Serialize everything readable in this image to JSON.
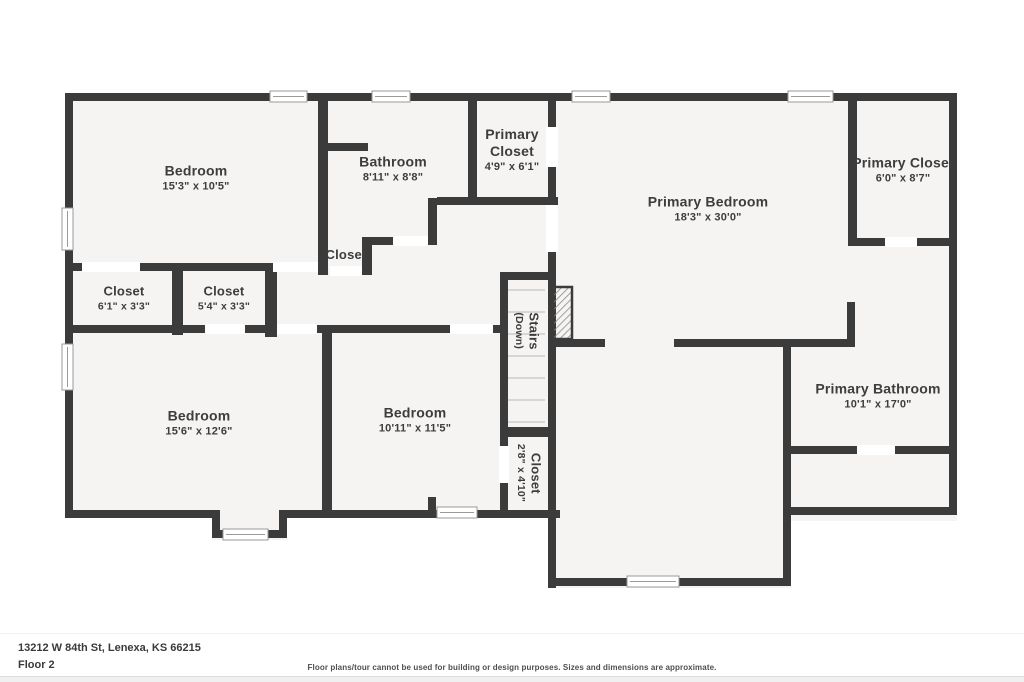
{
  "colors": {
    "wall": "#3b3b3b",
    "floor": "#f5f4f2",
    "door": "#ffffff",
    "window_frame": "#9a9a9a",
    "tread": "#cccccc",
    "hatch": "#8a8a8a",
    "label": "#3d3d3d",
    "footer_text": "#3a3a3a",
    "disclaimer": "#4f4f4f",
    "page_bg": "#ffffff"
  },
  "rooms": [
    {
      "name": "Bedroom",
      "dims": "15'3\" x 10'5\""
    },
    {
      "name": "Bathroom",
      "dims": "8'11\" x 8'8\""
    },
    {
      "name": "Primary Closet",
      "dims": "4'9\" x 6'1\""
    },
    {
      "name": "Primary Bedroom",
      "dims": "18'3\" x 30'0\""
    },
    {
      "name": "Primary Closet",
      "dims": "6'0\" x 8'7\""
    },
    {
      "name": "Closet",
      "dims": ""
    },
    {
      "name": "Closet",
      "dims": "6'1\" x 3'3\""
    },
    {
      "name": "Closet",
      "dims": "5'4\" x 3'3\""
    },
    {
      "name": "Stairs",
      "note": "(Down)"
    },
    {
      "name": "Closet",
      "dims": "2'8\" x 4'10\""
    },
    {
      "name": "Bedroom",
      "dims": "15'6\" x 12'6\""
    },
    {
      "name": "Bedroom",
      "dims": "10'11\" x 11'5\""
    },
    {
      "name": "Primary Bathroom",
      "dims": "10'1\" x 17'0\""
    }
  ],
  "footer": {
    "address": "13212 W 84th St, Lenexa, KS 66215",
    "floor_label": "Floor 2",
    "disclaimer": "Floor plans/tour cannot be used for building or design purposes. Sizes and dimensions are approximate."
  }
}
